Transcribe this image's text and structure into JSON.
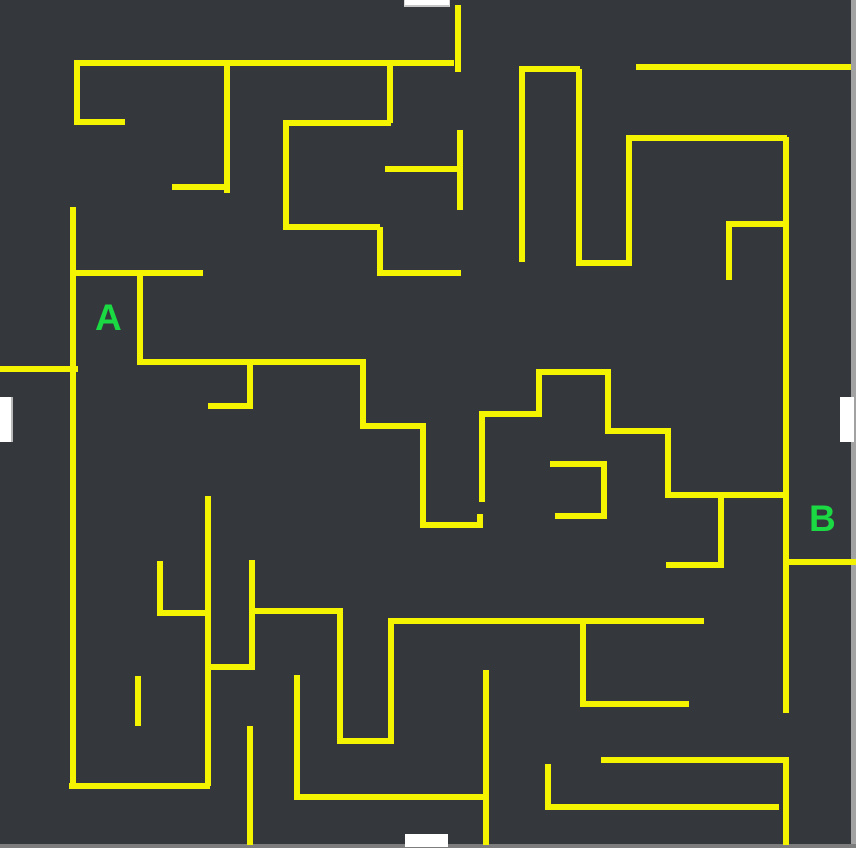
{
  "maze": {
    "width": 856,
    "height": 848,
    "colors": {
      "background": "#34373b",
      "wall": "#f4f400",
      "label": "#1bd943",
      "opening": "#ffffff",
      "frame_right": "#a2a2a2",
      "frame_bottom": "#7d7d7d"
    },
    "labels": [
      {
        "text": "A",
        "x": 95,
        "y": 299
      },
      {
        "text": "B",
        "x": 809,
        "y": 500
      }
    ],
    "openings": [
      {
        "side": "top",
        "x": 404,
        "y": 0,
        "w": 46,
        "h": 7
      },
      {
        "side": "left",
        "x": 0,
        "y": 397,
        "w": 13,
        "h": 45
      },
      {
        "side": "right",
        "x": 840,
        "y": 397,
        "w": 14,
        "h": 45
      },
      {
        "side": "bottom",
        "x": 405,
        "y": 834,
        "w": 43,
        "h": 13
      }
    ],
    "walls": [
      [
        74,
        60,
        380,
        6
      ],
      [
        74,
        63,
        6,
        62
      ],
      [
        74,
        119,
        51,
        6
      ],
      [
        224,
        63,
        6,
        130
      ],
      [
        172,
        184,
        56,
        6
      ],
      [
        387,
        63,
        6,
        60
      ],
      [
        283,
        120,
        108,
        6
      ],
      [
        283,
        123,
        6,
        104
      ],
      [
        283,
        224,
        97,
        6
      ],
      [
        377,
        227,
        6,
        46
      ],
      [
        377,
        270,
        84,
        6
      ],
      [
        385,
        166,
        75,
        6
      ],
      [
        457,
        130,
        6,
        80
      ],
      [
        455,
        5,
        6,
        67
      ],
      [
        519,
        66,
        61,
        6
      ],
      [
        519,
        69,
        6,
        193
      ],
      [
        576,
        69,
        6,
        194
      ],
      [
        576,
        260,
        56,
        6
      ],
      [
        626,
        136,
        6,
        128
      ],
      [
        626,
        135,
        161,
        6
      ],
      [
        636,
        64,
        215,
        6
      ],
      [
        783,
        137,
        6,
        576
      ],
      [
        726,
        221,
        60,
        6
      ],
      [
        726,
        224,
        6,
        56
      ],
      [
        70,
        270,
        133,
        6
      ],
      [
        70,
        207,
        6,
        582
      ],
      [
        137,
        273,
        6,
        89
      ],
      [
        0,
        366,
        78,
        6
      ],
      [
        137,
        359,
        228,
        6
      ],
      [
        247,
        359,
        6,
        50
      ],
      [
        208,
        403,
        45,
        6
      ],
      [
        360,
        359,
        6,
        67
      ],
      [
        360,
        423,
        65,
        6
      ],
      [
        420,
        423,
        6,
        105
      ],
      [
        420,
        522,
        63,
        6
      ],
      [
        477,
        514,
        6,
        10
      ],
      [
        479,
        411,
        6,
        91
      ],
      [
        479,
        411,
        61,
        6
      ],
      [
        536,
        369,
        6,
        48
      ],
      [
        536,
        369,
        75,
        6
      ],
      [
        605,
        369,
        6,
        65
      ],
      [
        605,
        428,
        64,
        6
      ],
      [
        665,
        428,
        6,
        70
      ],
      [
        665,
        492,
        121,
        6
      ],
      [
        718,
        495,
        6,
        71
      ],
      [
        666,
        562,
        58,
        6
      ],
      [
        550,
        461,
        57,
        6
      ],
      [
        601,
        461,
        6,
        58
      ],
      [
        555,
        513,
        52,
        6
      ],
      [
        783,
        559,
        73,
        6
      ],
      [
        157,
        561,
        6,
        55
      ],
      [
        157,
        610,
        51,
        6
      ],
      [
        205,
        496,
        6,
        290
      ],
      [
        249,
        560,
        6,
        110
      ],
      [
        205,
        664,
        48,
        6
      ],
      [
        249,
        608,
        92,
        6
      ],
      [
        337,
        608,
        6,
        136
      ],
      [
        388,
        618,
        6,
        126
      ],
      [
        337,
        738,
        57,
        6
      ],
      [
        390,
        618,
        314,
        6
      ],
      [
        580,
        621,
        6,
        86
      ],
      [
        581,
        701,
        108,
        6
      ],
      [
        135,
        676,
        6,
        50
      ],
      [
        247,
        726,
        6,
        119
      ],
      [
        294,
        675,
        6,
        125
      ],
      [
        295,
        794,
        191,
        6
      ],
      [
        483,
        670,
        6,
        175
      ],
      [
        545,
        764,
        6,
        46
      ],
      [
        545,
        804,
        234,
        6
      ],
      [
        601,
        757,
        183,
        6
      ],
      [
        783,
        757,
        6,
        88
      ],
      [
        69,
        783,
        141,
        6
      ]
    ]
  }
}
